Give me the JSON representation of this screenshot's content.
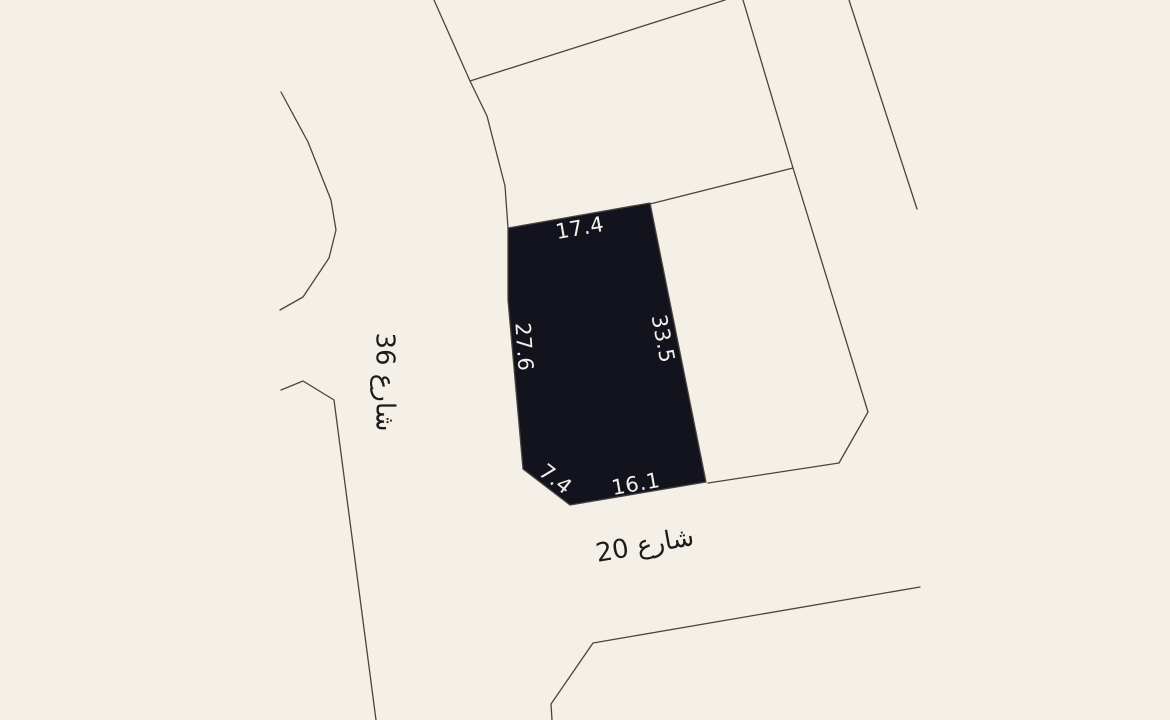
{
  "map": {
    "width": 1170,
    "height": 720,
    "background_color": "#f5f0e7",
    "boundary_color": "#4a443e",
    "boundary_stroke_width": 1.3,
    "parcel": {
      "fill_color": "#13131d",
      "outline_color": "#4a443e",
      "points": [
        [
          508,
          228
        ],
        [
          650,
          203
        ],
        [
          706,
          482
        ],
        [
          570,
          505
        ],
        [
          523,
          469
        ],
        [
          508,
          300
        ]
      ],
      "dimension_label_color": "#f2efe8",
      "dimension_labels": [
        {
          "text": "17.4",
          "x": 580,
          "y": 229,
          "rotation": -10
        },
        {
          "text": "33.5",
          "x": 662,
          "y": 339,
          "rotation": 79
        },
        {
          "text": "27.6",
          "x": 523,
          "y": 347,
          "rotation": 86
        },
        {
          "text": "7.4",
          "x": 555,
          "y": 480,
          "rotation": 38
        },
        {
          "text": "16.1",
          "x": 636,
          "y": 485,
          "rotation": -10
        }
      ]
    },
    "street_label_color": "#1c1c1c",
    "street_labels": [
      {
        "text": "شارع 36",
        "x": 384,
        "y": 382,
        "rotation": 90
      },
      {
        "text": "شارع 20",
        "x": 645,
        "y": 546,
        "rotation": -10
      }
    ],
    "boundaries": [
      {
        "points": [
          [
            434,
            0
          ],
          [
            470,
            81
          ],
          [
            487,
            116
          ],
          [
            505,
            186
          ],
          [
            508,
            228
          ]
        ]
      },
      {
        "points": [
          [
            470,
            81
          ],
          [
            725,
            0
          ]
        ]
      },
      {
        "points": [
          [
            743,
            0
          ],
          [
            793,
            168
          ],
          [
            868,
            412
          ],
          [
            839,
            463
          ],
          [
            708,
            483
          ]
        ]
      },
      {
        "points": [
          [
            650,
            204
          ],
          [
            793,
            168
          ]
        ]
      },
      {
        "points": [
          [
            849,
            0
          ],
          [
            917,
            209
          ]
        ]
      },
      {
        "points": [
          [
            281,
            92
          ],
          [
            308,
            142
          ],
          [
            331,
            200
          ],
          [
            336,
            230
          ],
          [
            329,
            258
          ],
          [
            303,
            297
          ],
          [
            280,
            310
          ]
        ]
      },
      {
        "points": [
          [
            281,
            390
          ],
          [
            303,
            381
          ],
          [
            334,
            400
          ],
          [
            376,
            720
          ]
        ]
      },
      {
        "points": [
          [
            552,
            720
          ],
          [
            551,
            704
          ],
          [
            593,
            643
          ],
          [
            920,
            587
          ]
        ]
      }
    ]
  }
}
